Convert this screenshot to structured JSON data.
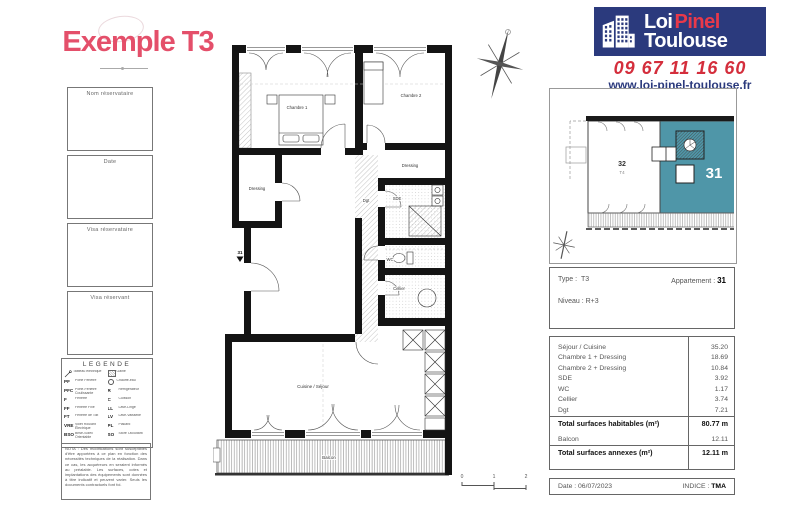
{
  "title": "Exemple T3",
  "branding": {
    "logo": {
      "word1": "Loi",
      "word2": "Pinel",
      "word3": "Toulouse"
    },
    "phone": "09 67 11 16 60",
    "website": "www.loi-pinel-toulouse.fr"
  },
  "colors": {
    "accent_pink": "#e44f6a",
    "brand_blue": "#2b3a7d",
    "brand_red": "#d42e3c",
    "unit_teal": "#4f96a8"
  },
  "left_panel": {
    "boxes": [
      {
        "label": "Nom réservataire"
      },
      {
        "label": "Date"
      },
      {
        "label": "Visa réservataire"
      },
      {
        "label": "Visa réservant"
      }
    ],
    "legend": {
      "title": "LEGENDE",
      "left": [
        {
          "abbr": "",
          "desc": "Tableau électrique"
        },
        {
          "abbr": "PF",
          "desc": "Porte Fenêtre"
        },
        {
          "abbr": "PFC",
          "desc": "Porte-Fenêtre Coulissante"
        },
        {
          "abbr": "F",
          "desc": "Fenêtre"
        },
        {
          "abbr": "FF",
          "desc": "Fenêtre Fixe"
        },
        {
          "abbr": "FT",
          "desc": "Fenêtre de Toit"
        },
        {
          "abbr": "VRE",
          "desc": "Volet Roulant Électrique"
        },
        {
          "abbr": "BSO",
          "desc": "Brise-Soleil Orientable"
        }
      ],
      "right": [
        {
          "abbr": "",
          "desc": "Gaine"
        },
        {
          "abbr": "",
          "desc": "Chauffe-eau"
        },
        {
          "abbr": "R",
          "desc": "Réfrigérateur"
        },
        {
          "abbr": "C",
          "desc": "Cuisson"
        },
        {
          "abbr": "LL",
          "desc": "Lave-Linge"
        },
        {
          "abbr": "LV",
          "desc": "Lave-Vaisselle"
        },
        {
          "abbr": "PL",
          "desc": "Placard"
        },
        {
          "abbr": "SO",
          "desc": "Store Occultant"
        }
      ]
    },
    "nota": "NOTA : Des modifications sont susceptibles d'être apportées à ce plan en fonction des nécessités techniques de la réalisation. Dans ce cas, les acquéreurs en seraient informés au préalable. Les surfaces, cotes et implantations des équipements sont données à titre indicatif et peuvent varier. Seuls les documents contractuels font foi."
  },
  "floor_plan": {
    "unit_marker": "31",
    "rooms": {
      "chambre1": "Chambre 1",
      "chambre2": "Chambre 2",
      "dressing1": "Dressing",
      "dressing2": "Dressing",
      "dgt": "Dgt",
      "sde": "SDE",
      "wc": "WC",
      "cellier": "Cellier",
      "sejour": "Cuisine / Séjour",
      "balcon": "Balcon"
    },
    "scale": {
      "t0": "0",
      "t1": "1",
      "t2": "2"
    }
  },
  "site_plan": {
    "unit_highlight": "31",
    "unit_neighbor": "32",
    "unit_neighbor_type": "T4"
  },
  "info": {
    "type_label": "Type :",
    "type_value": "T3",
    "apartment_label": "Appartement :",
    "apartment_value": "31",
    "level": "Niveau : R+3"
  },
  "areas": {
    "rows": [
      {
        "label": "Séjour / Cuisine",
        "value": "35.20"
      },
      {
        "label": "Chambre 1 + Dressing",
        "value": "18.69"
      },
      {
        "label": "Chambre 2 + Dressing",
        "value": "10.84"
      },
      {
        "label": "SDE",
        "value": "3.92"
      },
      {
        "label": "WC",
        "value": "1.17"
      },
      {
        "label": "Cellier",
        "value": "3.74"
      },
      {
        "label": "Dgt",
        "value": "7.21"
      }
    ],
    "total_habitable": {
      "label": "Total surfaces habitables (m²)",
      "value": "80.77 m"
    },
    "annex_rows": [
      {
        "label": "Balcon",
        "value": "12.11"
      }
    ],
    "total_annex": {
      "label": "Total surfaces annexes (m²)",
      "value": "12.11 m"
    }
  },
  "footer": {
    "date_label": "Date :",
    "date_value": "06/07/2023",
    "indice_label": "INDICE :",
    "indice_value": "TMA"
  }
}
